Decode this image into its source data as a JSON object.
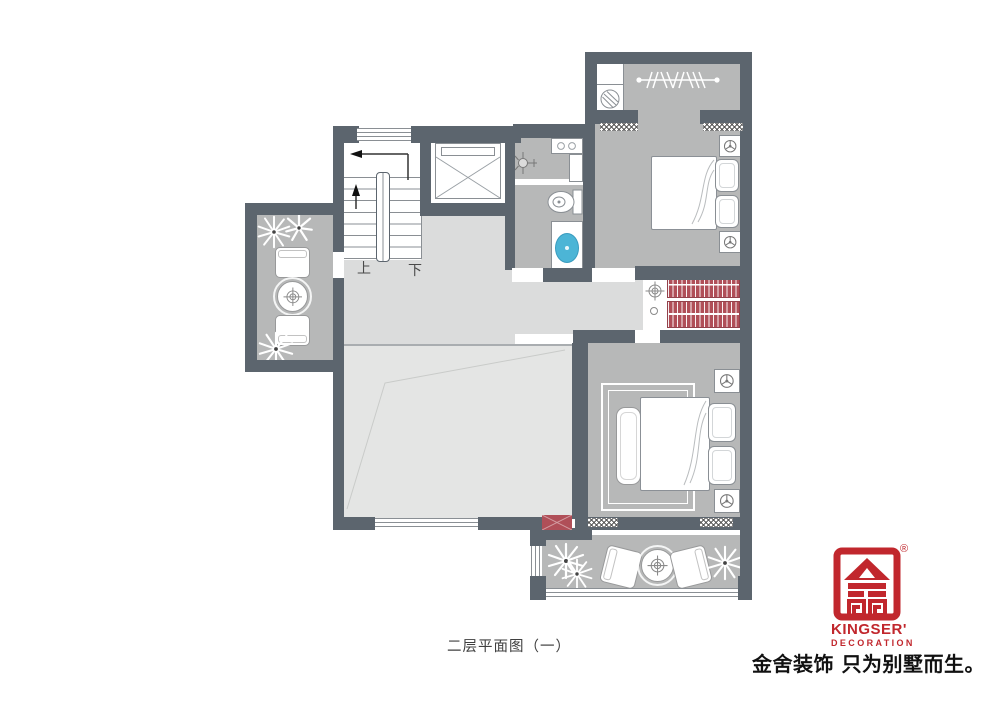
{
  "caption": "二层平面图（一）",
  "stairs": {
    "up_label": "上",
    "down_label": "下"
  },
  "logo": {
    "brand": "KINGSER'",
    "brand_sub": "DECORATION",
    "registered_mark": "®",
    "slogan": "金舍装饰 只为别墅而生。"
  },
  "colors": {
    "wall": "#5c656e",
    "room_floor": "#b7b8b8",
    "hall_floor": "#dbdcdc",
    "void_floor": "#e4e5e4",
    "stair_floor": "#ffffff",
    "wardrobe_red": "#b04f58",
    "sink_blue": "#4cb5d6",
    "logo_red": "#c1272d",
    "line": "#8a8f94",
    "text": "#3f3f3f"
  },
  "icons": [
    "stairs",
    "elevator",
    "washing-machine",
    "drying-rack",
    "shower",
    "toilet",
    "sink",
    "bed",
    "pillow",
    "nightstand-lamp",
    "wardrobe-hanging-clothes",
    "rug",
    "bench",
    "armchair",
    "round-table",
    "plant",
    "air-conditioner",
    "crosshair-target",
    "void-marker",
    "door-sill",
    "window"
  ]
}
